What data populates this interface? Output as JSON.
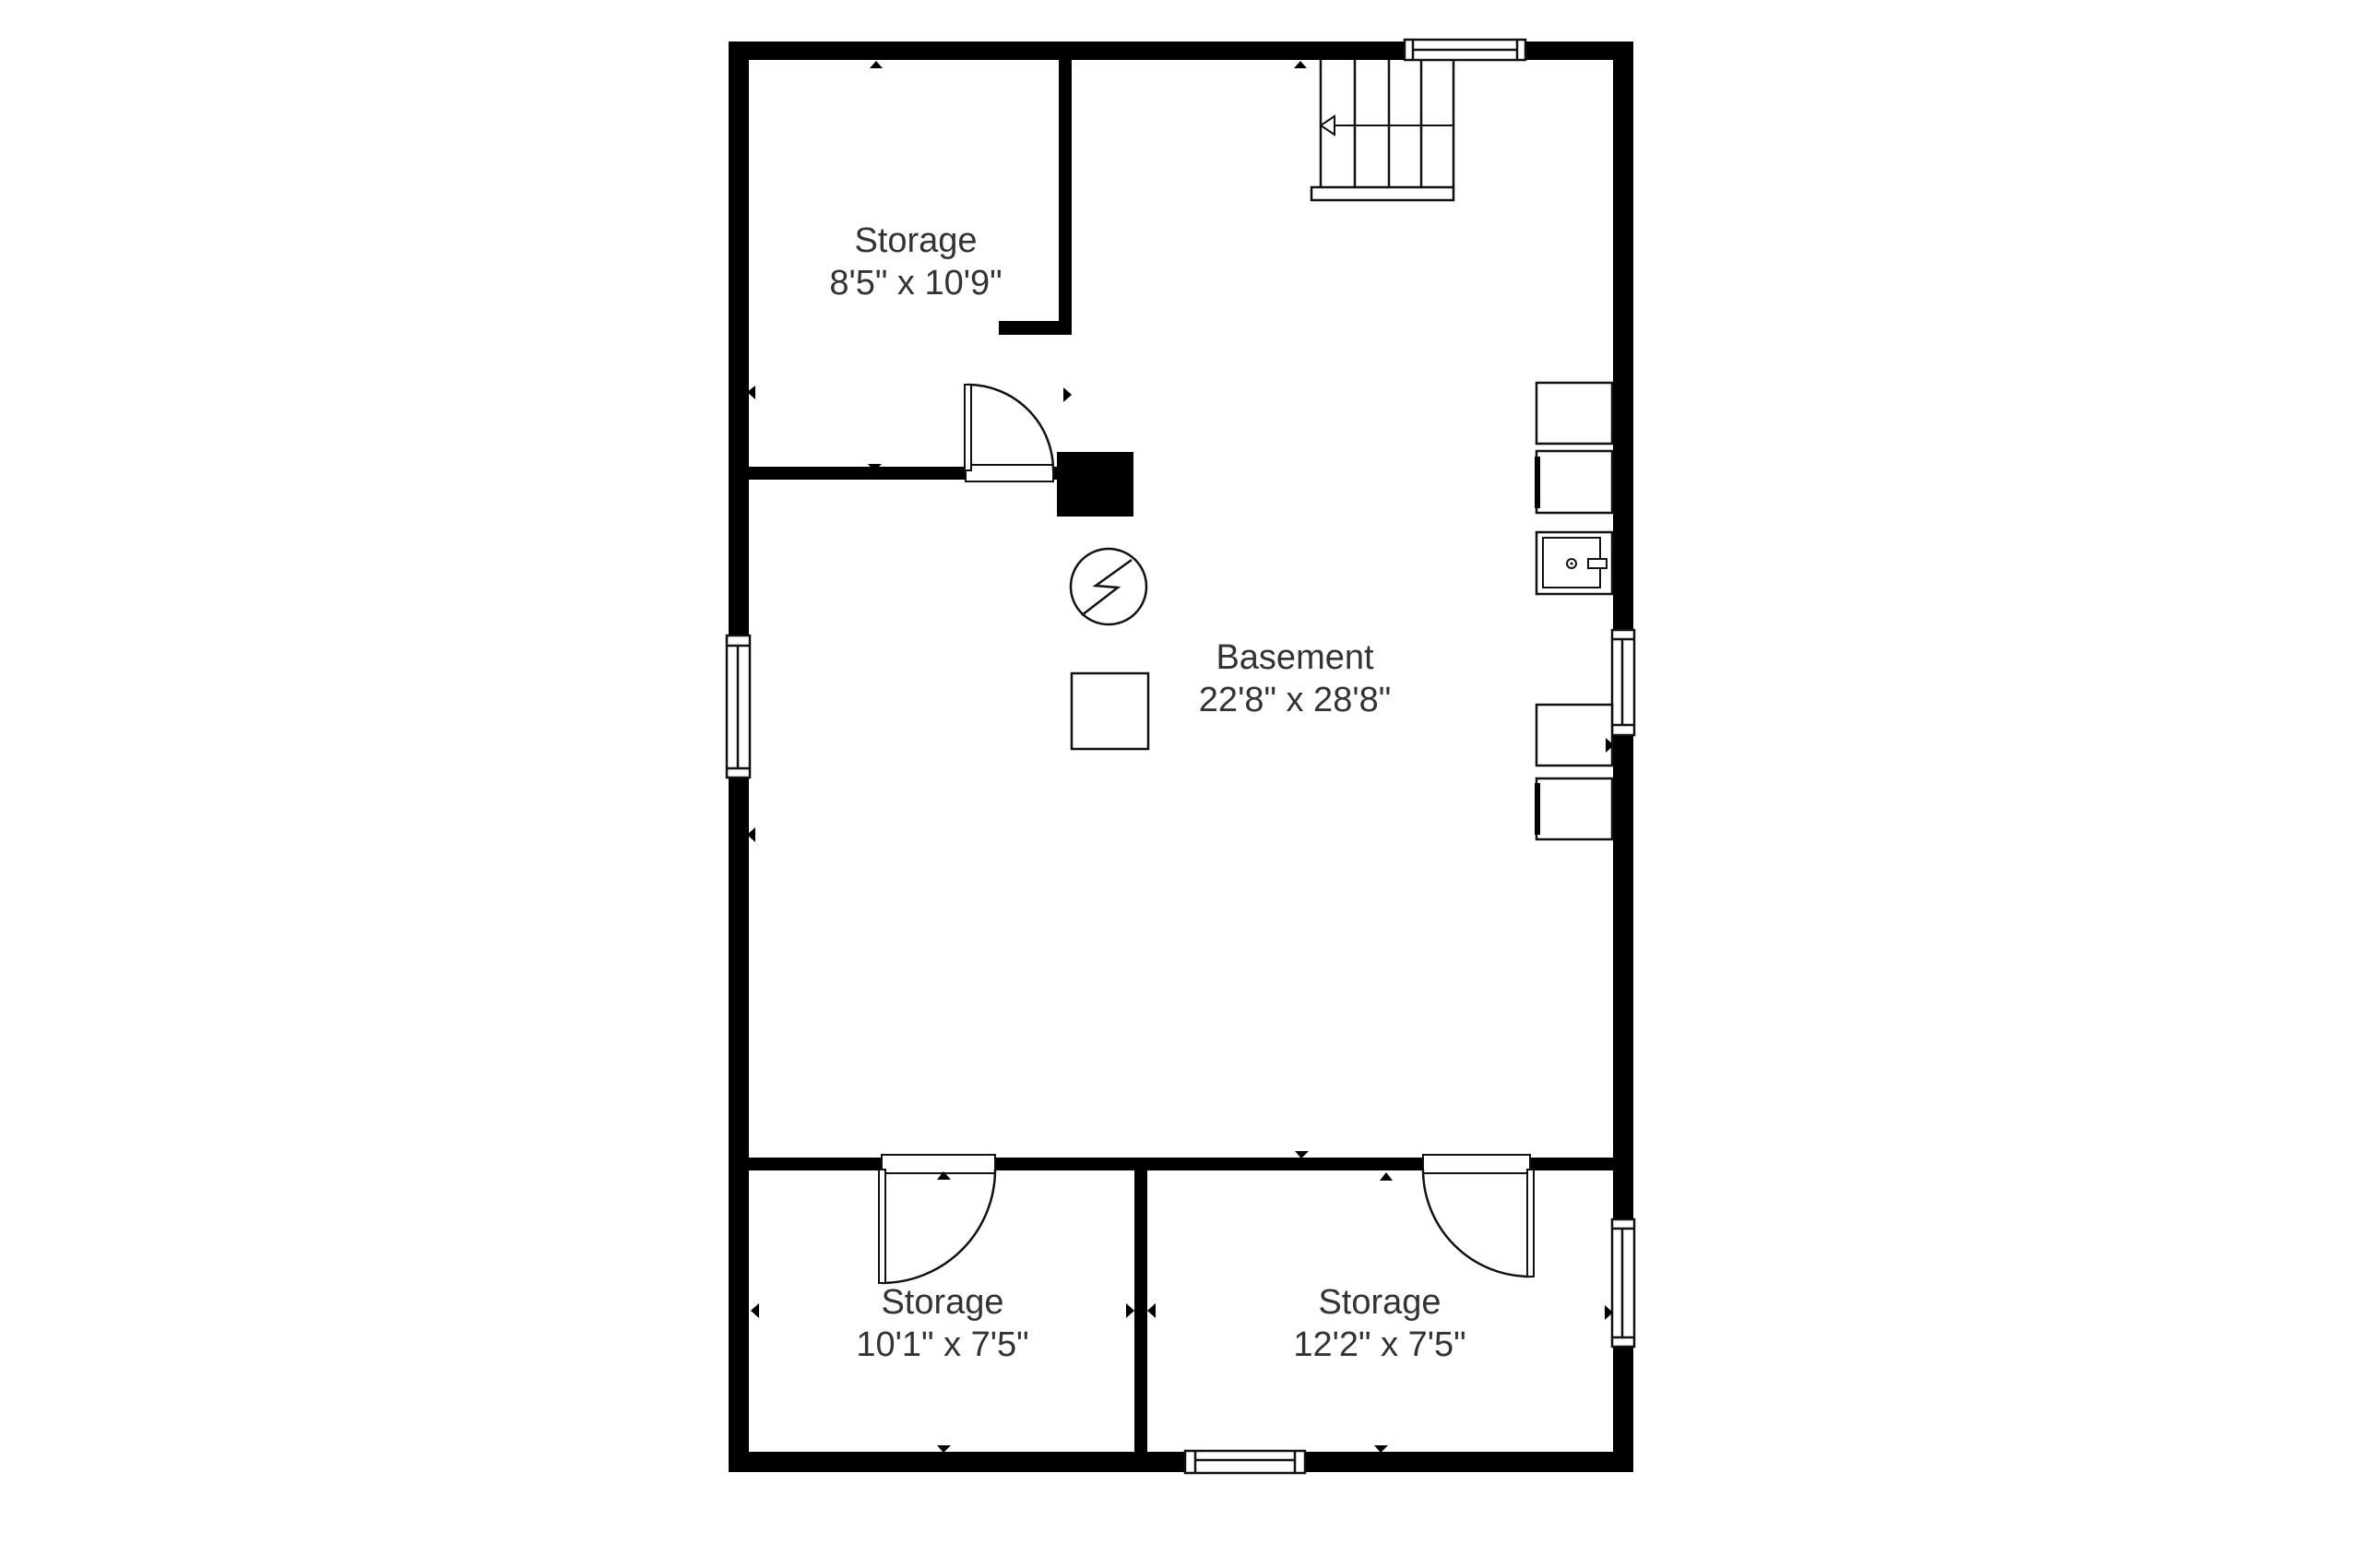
{
  "title": "Basement floor plan",
  "colors": {
    "wall": "#000000",
    "line": "#111111",
    "text": "#333333",
    "background": "#ffffff"
  },
  "rooms": [
    {
      "id": "storage-top-left",
      "name": "Storage",
      "dimensions": "8'5\" x 10'9\""
    },
    {
      "id": "basement",
      "name": "Basement",
      "dimensions": "22'8\" x 28'8\""
    },
    {
      "id": "storage-bottom-left",
      "name": "Storage",
      "dimensions": "10'1\" x 7'5\""
    },
    {
      "id": "storage-bottom-right",
      "name": "Storage",
      "dimensions": "12'2\" x 7'5\""
    }
  ],
  "icons": {
    "electric_meter": "circle-with-lightning-bolt",
    "stairs_direction": "open-left-arrow",
    "dimension_marker": "filled-triangle",
    "window": "double-line-window",
    "door": "quarter-arc-swing"
  },
  "fixtures": [
    "stairs-with-landing",
    "chimney-block",
    "electric-meter-symbol",
    "utility-pad",
    "storage-box",
    "storage-box-door-left",
    "appliance-washer",
    "storage-box",
    "storage-box-door-left"
  ]
}
